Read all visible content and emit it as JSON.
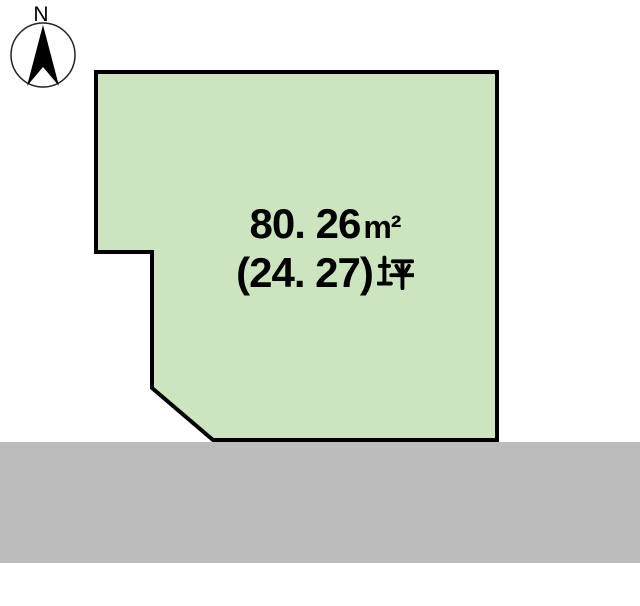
{
  "canvas": {
    "width": 640,
    "height": 606,
    "background": "#ffffff"
  },
  "compass": {
    "label": "N",
    "ring_color": "#222222",
    "needle_color": "#000000"
  },
  "parcel": {
    "fill": "#cde4c0",
    "border_color": "#000000",
    "area_m2": "80. 26",
    "area_m2_unit": "m²",
    "area_tsubo": "(24. 27)",
    "area_tsubo_unit": "坪"
  },
  "road": {
    "fill": "#bcbcbc"
  }
}
